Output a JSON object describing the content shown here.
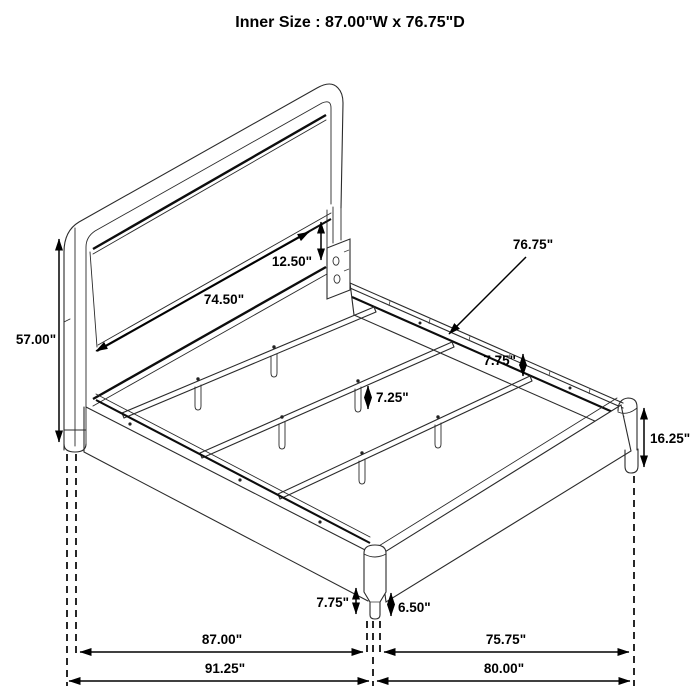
{
  "title": "Inner Size : 87.00\"W x 76.75\"D",
  "diagram": {
    "subject": "bed-frame-isometric-dimension-drawing",
    "line_color": "#1a1a1a",
    "background_color": "#ffffff",
    "labels": {
      "headboard_height": "57.00\"",
      "headboard_inner_width": "74.50\"",
      "headboard_panel_gap": "12.50\"",
      "slat_area_depth": "76.75\"",
      "side_rail_height": "7.75\"",
      "center_leg_height": "7.25\"",
      "footboard_corner_height": "16.25\"",
      "front_leg_height": "7.75\"",
      "front_leg_lower_height": "6.50\"",
      "inner_width": "87.00\"",
      "inner_depth": "75.75\"",
      "overall_width": "91.25\"",
      "overall_depth": "80.00\""
    }
  }
}
